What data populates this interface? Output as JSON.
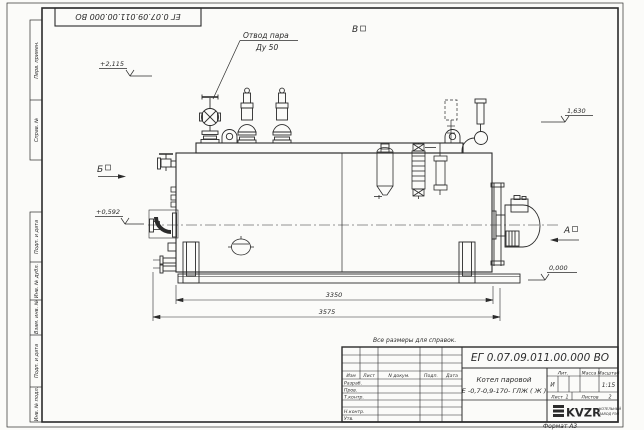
{
  "sheet": {
    "stamp_number": "ЕГ 0.07.09.011.00.000  ВО",
    "note": "Все размеры для справок.",
    "format_label": "Формат А3",
    "side_columns": [
      "Перв. примен.",
      "Справ. №",
      "Подп. и дата",
      "Инв. № дубл.",
      "Взам. инв. №",
      "Подп. и дата",
      "Инв. № подл."
    ]
  },
  "title_block": {
    "doc_number": "ЕГ 0.07.09.011.00.000  ВО",
    "product_name_line1": "Котел паровой",
    "product_name_line2": "Е -0,7-0,9-170- ГЛЖ ( Ж )",
    "rev_headers": {
      "izm": "Изм",
      "list": "Лист",
      "doc": "N докум.",
      "sign": "Подп.",
      "date": "Дата"
    },
    "sig_rows": [
      "Разраб.",
      "Пров.",
      "Т.контр.",
      "Н.контр.",
      "Утв."
    ],
    "lit_label": "Лит.",
    "mass_label": "Масса",
    "scale_label": "Масштаб",
    "lit_value": "И",
    "scale_value": "1:15",
    "sheet_label": "Лист",
    "sheet_value": "1",
    "sheets_label": "Листов",
    "sheets_value": "2",
    "company_logo": "KVZR",
    "company_line1": "КОТЕЛЬНЫЙ",
    "company_line2": "ЗАВОД РЭП"
  },
  "drawing": {
    "callout_line1": "Отвод пара",
    "callout_line2": "Ду 50",
    "views": {
      "a": "А",
      "b": "Б",
      "v": "В"
    },
    "elevations": {
      "top": "+2,115",
      "middle": "+0,592",
      "right": "1,630",
      "zero": "0,000"
    },
    "dimensions": {
      "inner": "3350",
      "overall": "3575"
    }
  },
  "colors": {
    "line": "#2b2b2b",
    "paper": "#fbfbf9"
  }
}
